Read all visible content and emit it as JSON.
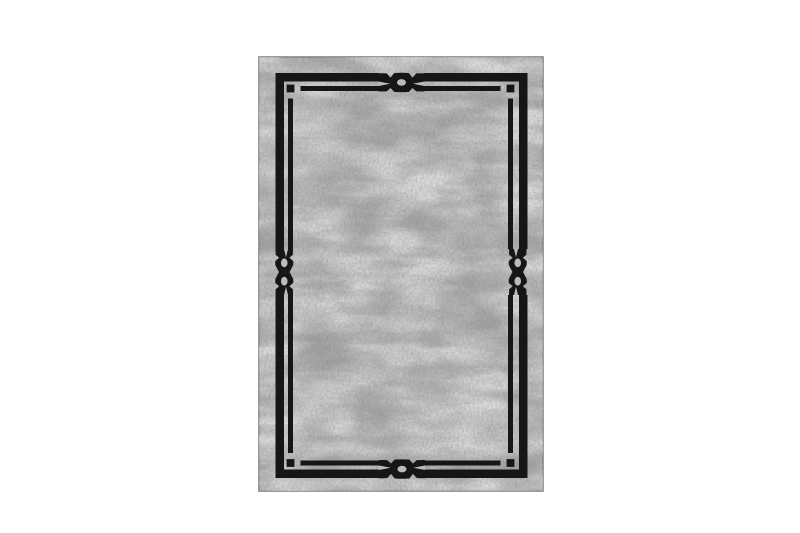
{
  "photo": {
    "description": "Product photo on a plain white background: a rectangular vintage-distressed gray rug with a black double-line frame border, a chain-knot motif centered on each of the four sides (single-loop on top and bottom, double-loop figure-eight on left and right), and a small detached black square at each inner-border corner"
  },
  "colors": {
    "background": "#ffffff",
    "frame_black": "#161616",
    "rug_base": "#bcbcbc",
    "rug_edge": "#909094",
    "texture_light": "#e4e4e4",
    "texture_dark": "#8d8d8d",
    "texture_grain": "#777777",
    "smudge_dark": "#8a8a8a",
    "smudge_light": "#e8e8e8"
  }
}
